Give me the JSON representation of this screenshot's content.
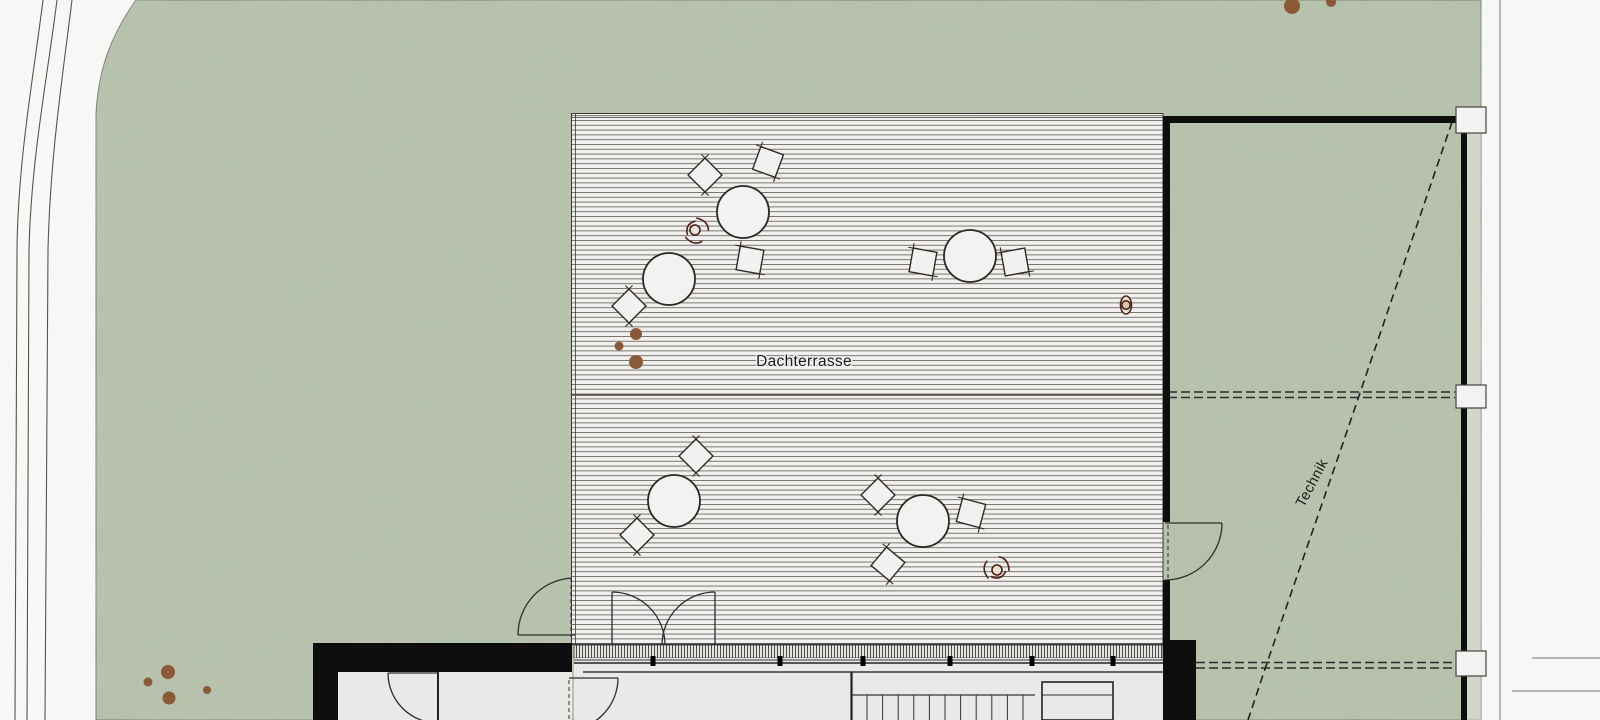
{
  "plan": {
    "labels": {
      "terrace_label": "Dachterrasse",
      "roof_label": "Technik"
    },
    "colors": {
      "green_base": "#b6c0aa",
      "green_mottle": "#8fa284",
      "road_white": "#f7f7f5",
      "deck_background": "#f1f0ee",
      "deck_line": "#6e6a66",
      "wall_black": "#0e0e0e",
      "drawing_line": "#3a3a3a",
      "interior_floor": "#e9eae7",
      "planting_dot_brown": "#8a5a38",
      "person_outline": "#4f2318",
      "column_fill": "#f2f2f0"
    },
    "furniture": {
      "table_radius": 26,
      "chair_size": 24,
      "tables": [
        {
          "cx": 743,
          "cy": 212
        },
        {
          "cx": 669,
          "cy": 279
        },
        {
          "cx": 970,
          "cy": 256
        },
        {
          "cx": 674,
          "cy": 501
        },
        {
          "cx": 923,
          "cy": 521
        }
      ],
      "chairs": [
        {
          "cx": 705,
          "cy": 175,
          "rot": 45
        },
        {
          "cx": 768,
          "cy": 162,
          "rot": 20
        },
        {
          "cx": 750,
          "cy": 260,
          "rot": 10
        },
        {
          "cx": 629,
          "cy": 306,
          "rot": 45
        },
        {
          "cx": 923,
          "cy": 262,
          "rot": 10
        },
        {
          "cx": 1015,
          "cy": 262,
          "rot": -10
        },
        {
          "cx": 696,
          "cy": 456,
          "rot": 45
        },
        {
          "cx": 637,
          "cy": 535,
          "rot": 45
        },
        {
          "cx": 878,
          "cy": 495,
          "rot": 45
        },
        {
          "cx": 971,
          "cy": 513,
          "rot": 15
        },
        {
          "cx": 888,
          "cy": 564,
          "rot": 40
        }
      ]
    },
    "persons": [
      {
        "cx": 695,
        "cy": 230,
        "rot": -60,
        "pose": "sitting"
      },
      {
        "cx": 1126,
        "cy": 305,
        "rot": 90,
        "pose": "standing"
      },
      {
        "cx": 997,
        "cy": 570,
        "rot": 160,
        "pose": "sitting"
      }
    ],
    "planting_dots": [
      {
        "cx": 636,
        "cy": 334,
        "r": 6
      },
      {
        "cx": 619,
        "cy": 346,
        "r": 4.5
      },
      {
        "cx": 636,
        "cy": 362,
        "r": 7
      },
      {
        "cx": 168,
        "cy": 672,
        "r": 7
      },
      {
        "cx": 148,
        "cy": 682,
        "r": 4.5
      },
      {
        "cx": 169,
        "cy": 698,
        "r": 6.5
      },
      {
        "cx": 207,
        "cy": 690,
        "r": 4
      },
      {
        "cx": 1292,
        "cy": 6,
        "r": 8
      },
      {
        "cx": 1331,
        "cy": 2,
        "r": 5
      }
    ],
    "stairs": {
      "tread_count": 11,
      "x_start": 867,
      "x_end": 1023,
      "y_top": 695,
      "y_bottom": 720
    },
    "columns": [
      {
        "x": 1456,
        "y": 107,
        "w": 30,
        "h": 26
      },
      {
        "x": 1456,
        "y": 385,
        "w": 30,
        "h": 23
      },
      {
        "x": 1456,
        "y": 651,
        "w": 30,
        "h": 25
      }
    ]
  }
}
